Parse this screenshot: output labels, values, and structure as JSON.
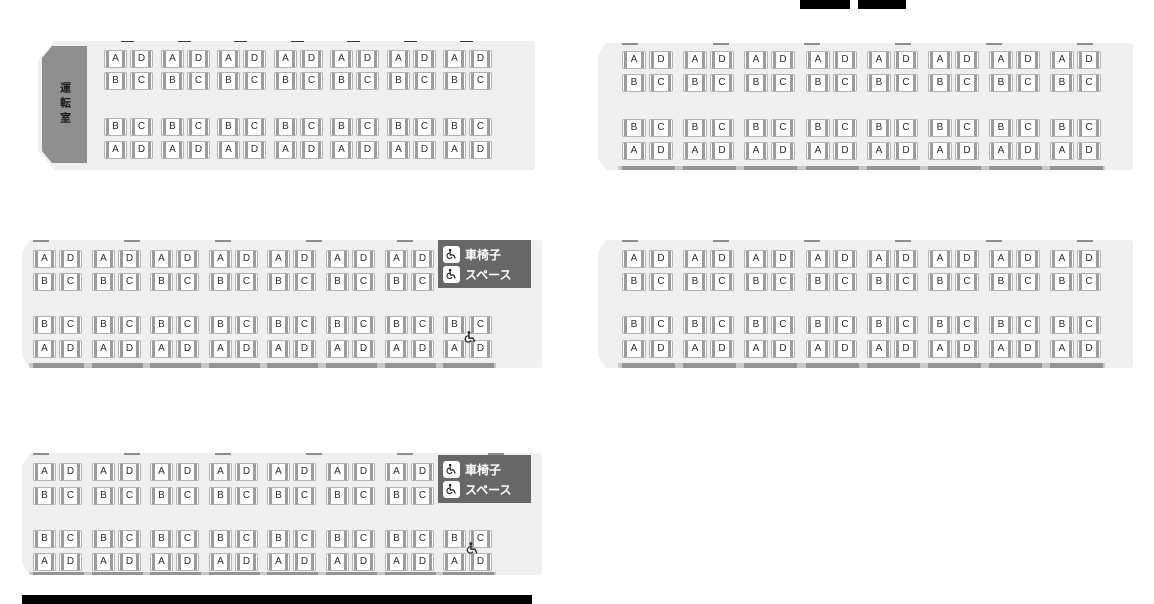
{
  "labels": {
    "driver_cab": "運転室",
    "exit": "出入り口",
    "wheelchair_line1": "車椅子",
    "wheelchair_line2": "スペース"
  },
  "seat_rows": {
    "upper_section": [
      [
        "A",
        "D"
      ],
      [
        "B",
        "C"
      ]
    ],
    "lower_section": [
      [
        "B",
        "C"
      ],
      [
        "A",
        "D"
      ]
    ]
  },
  "colors": {
    "car_body": "#efefef",
    "driver_cab": "#8f8f8f",
    "wheelchair_box": "#676767",
    "seat_fill": "#ffffff",
    "seat_border": "#b3b3b3",
    "seat_side_bar": "#9c9c9c",
    "seat_letter": "#2e2e2e",
    "label_text": "#111111",
    "wheelchair_box_text": "#ffffff"
  },
  "cars": [
    {
      "name": "car-1-top-left",
      "x": 38,
      "y": 41,
      "w": 497,
      "h": 129,
      "left_bevel": 16,
      "seats_x": 66,
      "pitch": 56.5,
      "seat_w": 23,
      "seat_h": 18,
      "row_offsets": [
        9,
        31,
        77,
        100
      ],
      "top_groups": 7,
      "bottom_groups": 7,
      "cab": {
        "x": 4,
        "y": 5,
        "w": 45,
        "h": 117
      },
      "bump": {
        "x": 497,
        "y": 31,
        "w": 17,
        "h": 56
      },
      "door_mark": {
        "x": 2,
        "y": 52
      },
      "top_marks": {
        "style": "dark",
        "count": 7
      },
      "bottom_band": null
    },
    {
      "name": "car-2-top-right",
      "x": 598,
      "y": 43,
      "w": 535,
      "h": 127,
      "left_bevel": 8,
      "seats_x": 24,
      "pitch": 61.2,
      "seat_w": 24,
      "seat_h": 18,
      "row_offsets": [
        8,
        31,
        76,
        99
      ],
      "top_groups": 8,
      "bottom_groups": 8,
      "bump": {
        "x": 535,
        "y": 35,
        "w": 14,
        "h": 50
      },
      "top_marks": {
        "style": "light",
        "count": 6
      },
      "bottom_band": {
        "h": 4
      }
    },
    {
      "name": "car-3-middle-left",
      "x": 22,
      "y": 240,
      "w": 520,
      "h": 128,
      "left_bevel": 8,
      "seats_x": 11,
      "pitch": 58.6,
      "seat_w": 23,
      "seat_h": 18,
      "row_offsets": [
        10,
        33,
        76,
        100
      ],
      "top_groups": 7,
      "bottom_groups": 8,
      "wheelchair_box": {
        "x": 416,
        "y": 0,
        "w": 93,
        "h": 48
      },
      "wheelchair_seat_icon": {
        "x": 441,
        "y": 90
      },
      "bump": {
        "x": 520,
        "y": 32,
        "w": 17,
        "h": 56
      },
      "top_marks": {
        "style": "light",
        "count": 6
      },
      "bottom_band": {
        "h": 5
      }
    },
    {
      "name": "car-4-middle-right",
      "x": 598,
      "y": 240,
      "w": 535,
      "h": 128,
      "left_bevel": 8,
      "seats_x": 24,
      "pitch": 61.2,
      "seat_w": 24,
      "seat_h": 18,
      "row_offsets": [
        10,
        33,
        76,
        100
      ],
      "top_groups": 8,
      "bottom_groups": 8,
      "bump": {
        "x": 535,
        "y": 38,
        "w": 14,
        "h": 50
      },
      "top_marks": {
        "style": "light",
        "count": 6
      },
      "bottom_band": {
        "h": 5
      }
    },
    {
      "name": "car-5-bottom-left",
      "x": 22,
      "y": 453,
      "w": 520,
      "h": 122,
      "left_bevel": 8,
      "seats_x": 11,
      "pitch": 58.6,
      "seat_w": 23,
      "seat_h": 18,
      "row_offsets": [
        10,
        34,
        77,
        100
      ],
      "top_groups": 7,
      "bottom_groups": 8,
      "wheelchair_box": {
        "x": 416,
        "y": 2,
        "w": 93,
        "h": 48
      },
      "wheelchair_seat_icon": {
        "x": 443,
        "y": 88
      },
      "bump": {
        "x": 520,
        "y": 32,
        "w": 17,
        "h": 55
      },
      "top_marks": {
        "style": "light",
        "count": 6
      },
      "bottom_band": {
        "h": 3
      }
    }
  ],
  "clipped_bars": [
    {
      "x": 800,
      "y": 0,
      "w": 50,
      "h": 9
    },
    {
      "x": 858,
      "y": 0,
      "w": 48,
      "h": 9
    },
    {
      "x": 22,
      "y": 595,
      "w": 510,
      "h": 9
    }
  ]
}
